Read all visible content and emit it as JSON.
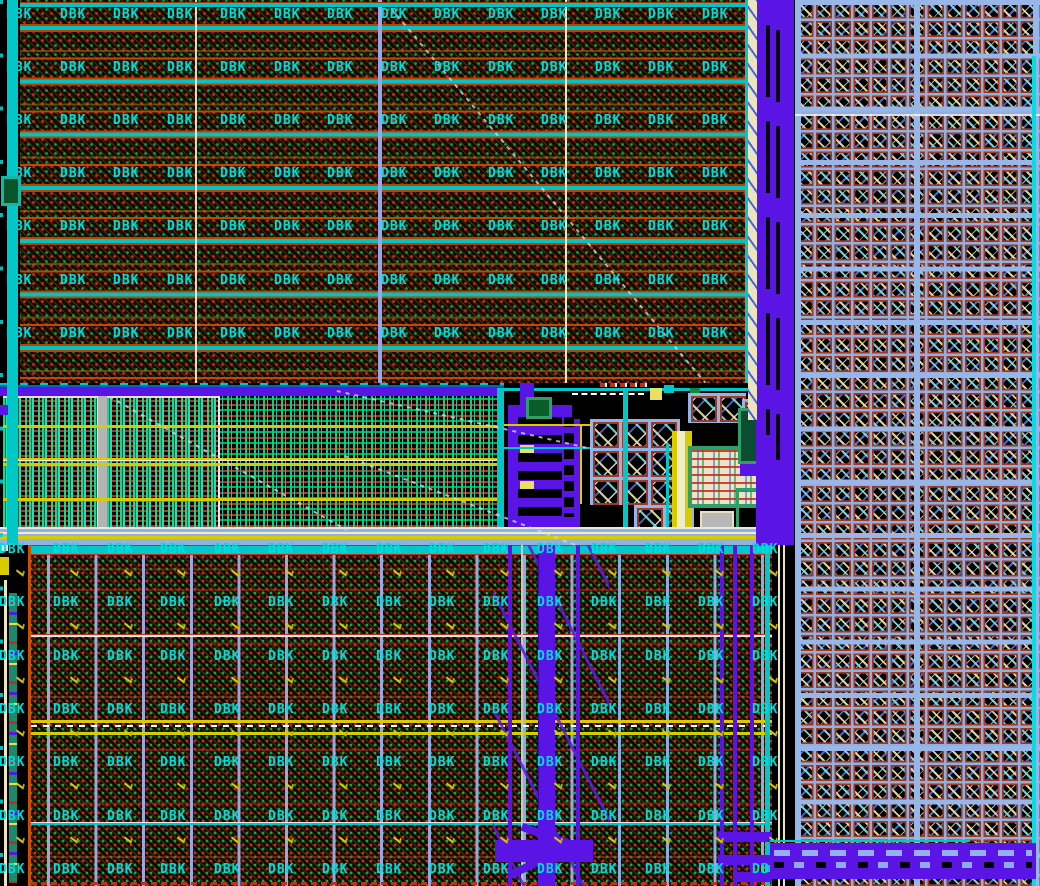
{
  "canvas": {
    "width": 1040,
    "height": 886
  },
  "labels": {
    "cell": "DBK"
  },
  "palette": {
    "label_cyan": "#00dcdc",
    "line_cyan": "#00c8c8",
    "violet": "#5a14e6",
    "periwinkle": "#92b0e4",
    "via_border_red": "#9c3824",
    "orange": "#c85000",
    "yellow": "#d8cc00",
    "cream": "#ece4c0",
    "dot_red": "#cc3014",
    "dot_green": "#00a44c",
    "teal_frame": "#2f9e68",
    "stripe_green": "#12d890",
    "stripe_teal": "#1ce0c0",
    "gray": "#b4b4b4"
  },
  "grids": {
    "top": {
      "label": "DBK",
      "rows": [
        8,
        61,
        114,
        167,
        220,
        274,
        327
      ],
      "cols": [
        6,
        60,
        113,
        167,
        220,
        274,
        327,
        381,
        434,
        488,
        541,
        595,
        648,
        702
      ],
      "marks": false
    },
    "bottom": {
      "label": "DBK",
      "rows": [
        543,
        596,
        650,
        703,
        756,
        810,
        863
      ],
      "cols": [
        -1,
        53,
        107,
        160,
        214,
        268,
        322,
        376,
        429,
        483,
        537,
        591,
        645,
        698,
        752
      ],
      "marks": true,
      "mark_dx": 17,
      "mark_dy": 26
    }
  }
}
